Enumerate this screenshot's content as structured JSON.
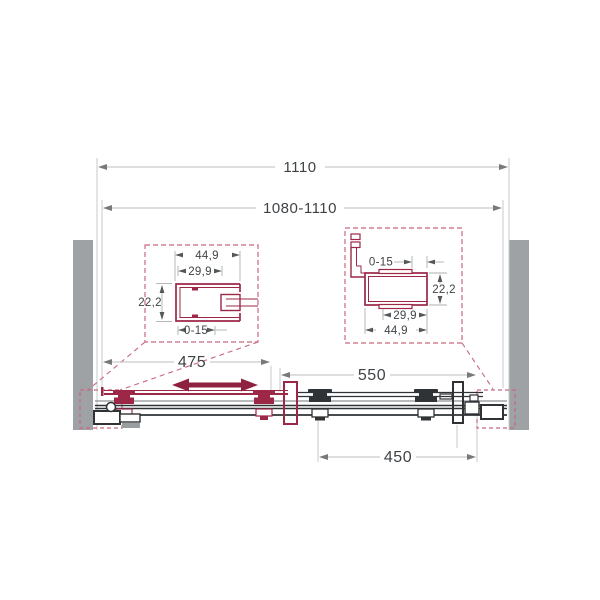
{
  "diagram": {
    "type": "sliding-shower-door-technical-drawing",
    "dimensions": {
      "overall_width": "1110",
      "adjustable_width": "1080-1110",
      "door_travel": "475",
      "opening_width": "550",
      "fixed_panel_width": "450"
    },
    "detail_left": {
      "outer_width": "44,9",
      "inner_width": "29,9",
      "depth": "22,2",
      "adjustment": "0-15"
    },
    "detail_right": {
      "adjustment": "0-15",
      "depth": "22,2",
      "inner_width": "29,9",
      "outer_width": "44,9"
    },
    "colors": {
      "profile_red": "#9c2747",
      "travel_arrow_red": "#8e2040",
      "dashed_red": "#c9677f",
      "line_dark": "#2f3336",
      "line_gray": "#8d9093",
      "dim_line_gray": "#bcbec0",
      "dim_arrow_gray": "#77797b",
      "text_color": "#3f4346",
      "wall_fill": "#9fa2a4"
    }
  }
}
